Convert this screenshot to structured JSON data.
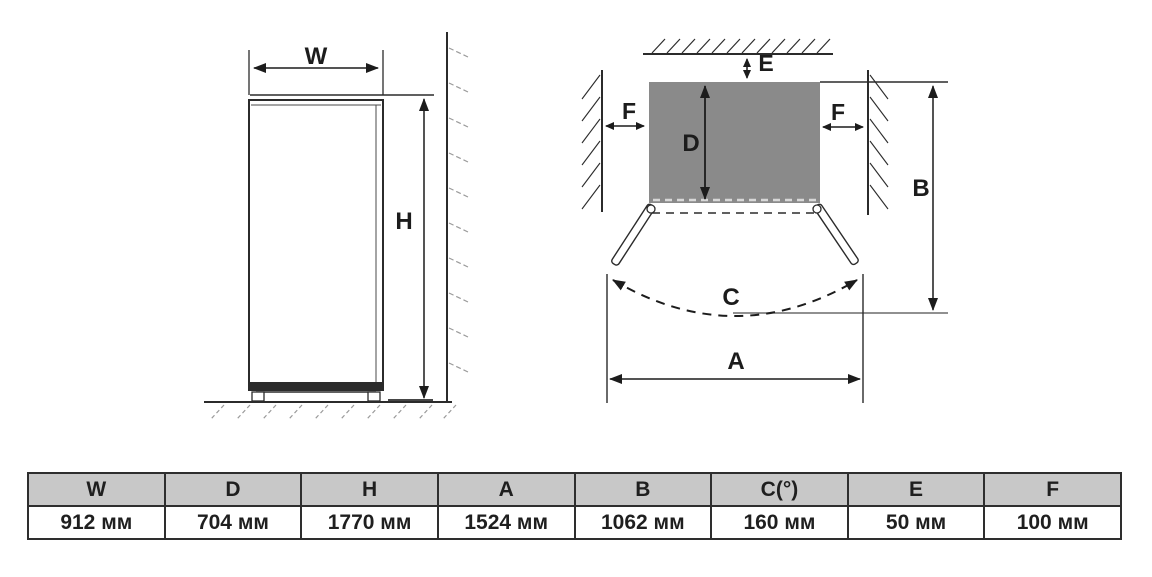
{
  "diagram": {
    "front_view": {
      "width_label": "W",
      "height_label": "H"
    },
    "top_view": {
      "depth_label": "D",
      "back_clearance_label": "E",
      "left_clearance_label": "F",
      "right_clearance_label": "F",
      "open_depth_label": "B",
      "door_swing_label": "C",
      "open_width_label": "A"
    }
  },
  "table": {
    "headers": [
      "W",
      "D",
      "H",
      "A",
      "B",
      "C(°)",
      "E",
      "F"
    ],
    "values": [
      "912 мм",
      "704 мм",
      "1770 мм",
      "1524 мм",
      "1062 мм",
      "160 мм",
      "50 мм",
      "100 мм"
    ]
  },
  "colors": {
    "line": "#2b2b2b",
    "cabinet_fill": "#8a8a8a",
    "table_header_bg": "#c8c8c8",
    "hatch_light": "#9a9a9a"
  }
}
